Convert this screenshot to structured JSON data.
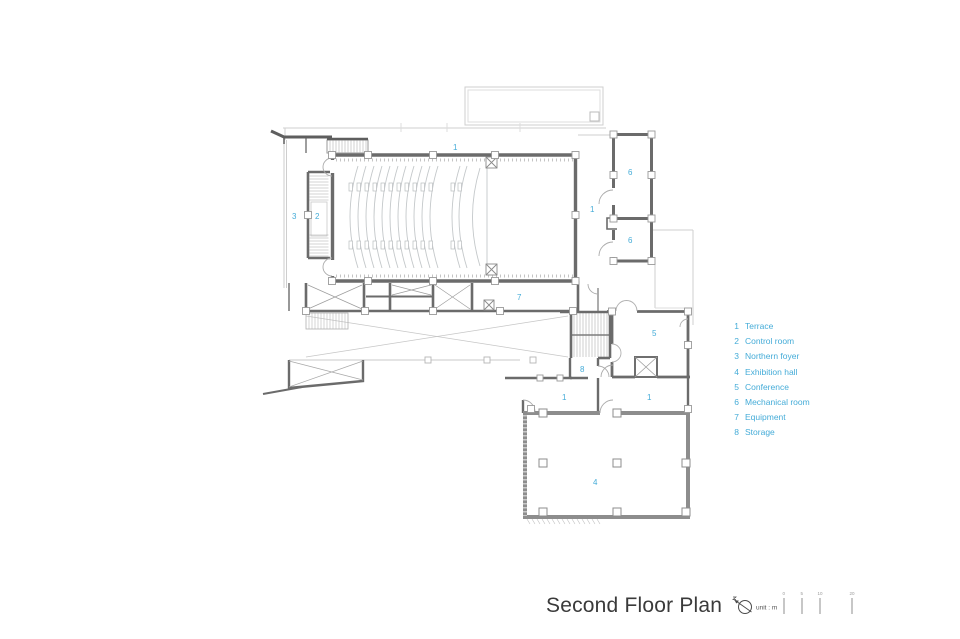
{
  "title": {
    "text": "Second Floor Plan",
    "unit_label": "unit : m",
    "scale_ticks": [
      "0",
      "5",
      "10",
      "20"
    ]
  },
  "legend": {
    "items": [
      {
        "num": "1",
        "label": "Terrace"
      },
      {
        "num": "2",
        "label": "Control room"
      },
      {
        "num": "3",
        "label": "Northern foyer"
      },
      {
        "num": "4",
        "label": "Exhibition hall"
      },
      {
        "num": "5",
        "label": "Conference"
      },
      {
        "num": "6",
        "label": "Mechanical room"
      },
      {
        "num": "7",
        "label": "Equipment"
      },
      {
        "num": "8",
        "label": "Storage"
      }
    ]
  },
  "plan": {
    "room_labels": [
      {
        "n": "1",
        "room": "terrace-north"
      },
      {
        "n": "1",
        "room": "terrace-east"
      },
      {
        "n": "2",
        "room": "control-room"
      },
      {
        "n": "3",
        "room": "northern-foyer"
      },
      {
        "n": "7",
        "room": "equipment"
      },
      {
        "n": "6",
        "room": "mechanical-upper"
      },
      {
        "n": "6",
        "room": "mechanical-lower"
      },
      {
        "n": "5",
        "room": "conference"
      },
      {
        "n": "8",
        "room": "storage"
      },
      {
        "n": "1",
        "room": "terrace-south-west"
      },
      {
        "n": "1",
        "room": "terrace-south-east"
      },
      {
        "n": "4",
        "room": "exhibition-hall"
      }
    ]
  },
  "colors": {
    "accent": "#45acd8",
    "wall_dark": "#6b6b6b",
    "wall_hall": "#8d8d8d",
    "light_line": "#cccccc",
    "title_text": "#3a3a3a"
  }
}
